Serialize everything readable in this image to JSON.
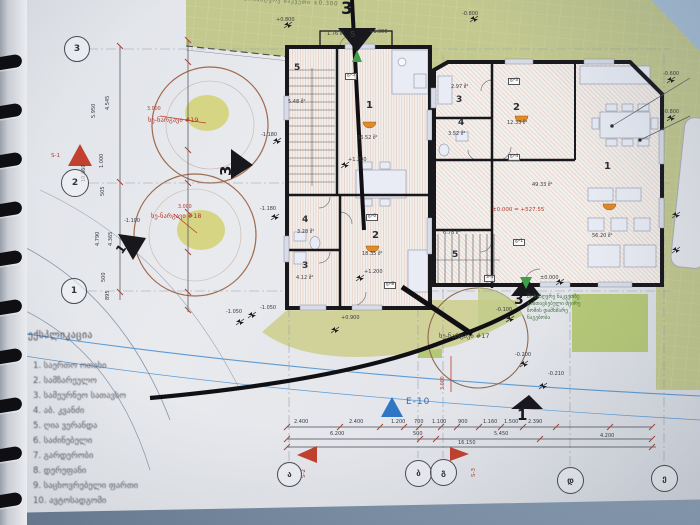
{
  "legend": {
    "title": "ექსპლიკაცია",
    "items": [
      "1. საერთო ოთახი",
      "2. სამზარეულო",
      "3. სამეურნეო სათავსო",
      "4. აბ. კვანძი",
      "5. ღია ვერანდა",
      "6. საძინებელი",
      "7. გარდერობი",
      "8. დერეფანი",
      "9. საცხოვრებელი ფართი",
      "10. ავტოსადგომი"
    ]
  },
  "grid": {
    "left": [
      "3",
      "2",
      "1"
    ],
    "bottom": [
      "ა",
      "ბ",
      "გ",
      "დ",
      "ე"
    ]
  },
  "sections": {
    "top": "3",
    "left": "3",
    "mid": "1",
    "bottom_center": "3",
    "bottom_right": "1",
    "s1": "S-1",
    "s2": "S-2",
    "s3": "S-3",
    "e10": "E-10"
  },
  "trees": {
    "t19": "ხე-ნარგავი #19",
    "t18": "ხე-ნარგავი #18",
    "t17": "ხე-ნარგავი #17",
    "r19": "3.000",
    "r18": "3.000",
    "r17": "3.000"
  },
  "site": {
    "top_note": "მოსაზღვრე ნაკვეთი ±0.300",
    "note": [
      "მოსაზღვრე ნაკვეთზე",
      "განთავსებული მცირე",
      "ზომის დამხმარე",
      "ნაგებობა"
    ]
  },
  "levels": {
    "a": "+0.800",
    "b": "-0.800",
    "c": "+1.300",
    "d": "+1.200",
    "e": "+1.200",
    "f": "-1.180",
    "g": "-1.180",
    "h": "-1.100",
    "i": "+0.900",
    "j": "-1.050",
    "k": "-1.050",
    "l": "-0.100",
    "m": "-0.200",
    "n": "-0.210",
    "o": "±0.000",
    "p": "-0.600",
    "q": "-0.800"
  },
  "rooms": {
    "l5": "5",
    "l5a": "5.48 მ²",
    "l1": "1",
    "l1a": "36.52 მ²",
    "l4": "4",
    "l4a": "3.28 მ²",
    "l3": "3",
    "l3a": "4.12 მ²",
    "l2": "2",
    "l2a": "18.35 მ²",
    "ver_num": "5",
    "ver_area": "1.76 მ²",
    "r3": "3",
    "r3a": "2.97 მ²",
    "r4": "4",
    "r4a": "3.52 მ²",
    "r2": "2",
    "r2a": "12.33 მ²",
    "r5": "5",
    "r5a": "6.78 მ²",
    "r1": "1",
    "r1a": "49.33 მ²",
    "r1b": "56.20 მ²",
    "datum": "±0.000 = +527.55"
  },
  "doors": {
    "t1": "დ-5",
    "t2": "დ-6",
    "t3": "დ-8",
    "t4": "დ-3",
    "t5": "დ-4",
    "t6": "დ-1",
    "t7": "3-4"
  },
  "dims": {
    "row1": [
      "2.400",
      "2.400",
      "1.200",
      "700",
      "1.100",
      "900",
      "1.160",
      "1.500",
      "2.390"
    ],
    "row2": [
      "6.200",
      "500",
      "5.450",
      "4.200"
    ],
    "total": "16.150",
    "left": [
      "5.950",
      "4.545",
      "10.660",
      "1.000",
      "505",
      "4.790",
      "4.365",
      "500",
      "895"
    ]
  }
}
